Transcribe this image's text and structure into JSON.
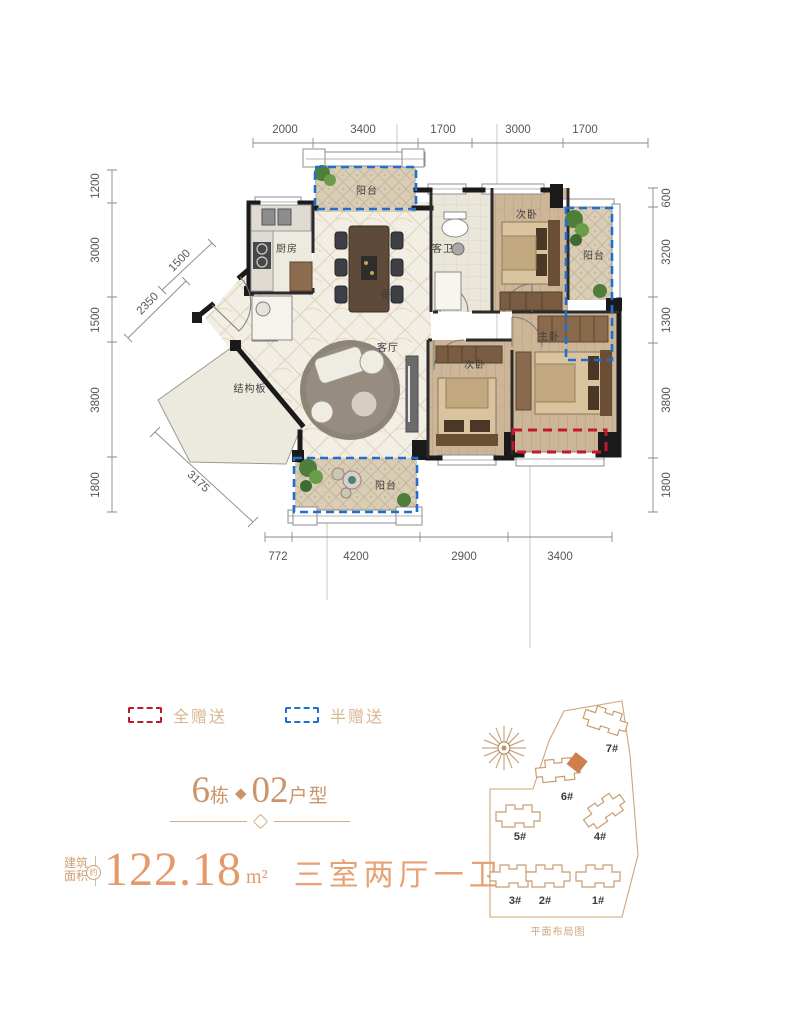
{
  "plan": {
    "rooms": {
      "balcony_top": "阳台",
      "kitchen": "厨房",
      "dining": "餐厅",
      "guest_bath": "客卫",
      "bedroom_top": "次卧",
      "balcony_right": "阳台",
      "master": "主卧",
      "bedroom_mid": "次卧",
      "living": "客厅",
      "structural": "结构板",
      "balcony_bottom": "阳台"
    },
    "dims": {
      "top": [
        "2000",
        "3400",
        "1700",
        "3000",
        "1700"
      ],
      "left": [
        "1200",
        "3000",
        "1500",
        "3800",
        "1800"
      ],
      "right": [
        "600",
        "3200",
        "1300",
        "3800",
        "1800"
      ],
      "bottom": [
        "772",
        "4200",
        "2900",
        "3400"
      ],
      "diag": [
        "1500",
        "2350",
        "3175"
      ]
    }
  },
  "legend": {
    "full_gift": "全赠送",
    "half_gift": "半赠送"
  },
  "unit_title": {
    "num1": "6",
    "label1": "栋",
    "diamond": "◆",
    "num2": "02",
    "label2": "户型"
  },
  "area": {
    "badge_line1": "建筑",
    "badge_line2": "面积",
    "about": "约",
    "value": "122.18",
    "unit": "m²",
    "rooms": "三室两厅一卫"
  },
  "siteplan": {
    "b7": "7#",
    "b6": "6#",
    "b5": "5#",
    "b4": "4#",
    "b3": "3#",
    "b2": "2#",
    "b1": "1#",
    "caption": "平面布局图"
  },
  "colors": {
    "gift_full": "#c2182e",
    "gift_half": "#1e6fce",
    "accent_orange": "#e59a6c",
    "site_tan": "#cfa678",
    "wall": "#1a1a1a"
  }
}
